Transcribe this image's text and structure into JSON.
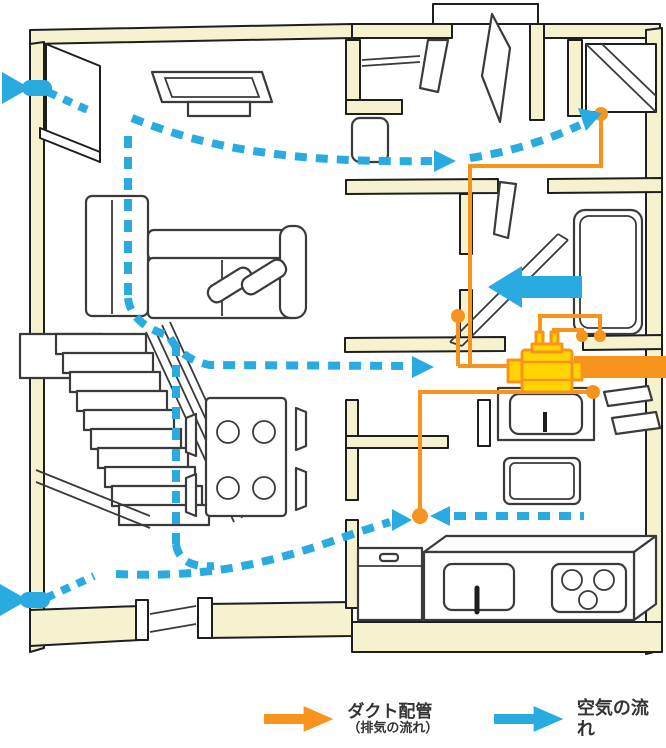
{
  "legend": {
    "duct": {
      "label": "ダクト配管",
      "sublabel": "（排気の流れ）"
    },
    "airflow": {
      "label": "空気の流れ"
    }
  },
  "icons": {
    "legend_duct_arrow": "right-arrow-orange",
    "legend_airflow_arrow": "right-arrow-blue",
    "air_inlet": "left-wall-air-inlet-arrow",
    "exhaust_fan": "central-exhaust-fan-unit"
  },
  "colors": {
    "wall": "#F6F1CF",
    "outline": "#1E1E1E",
    "furniture": "#3A3A3A",
    "blue": "#29ABE2",
    "orange": "#F7941E",
    "yellow": "#FFD400",
    "background": "#FFFFFF"
  }
}
